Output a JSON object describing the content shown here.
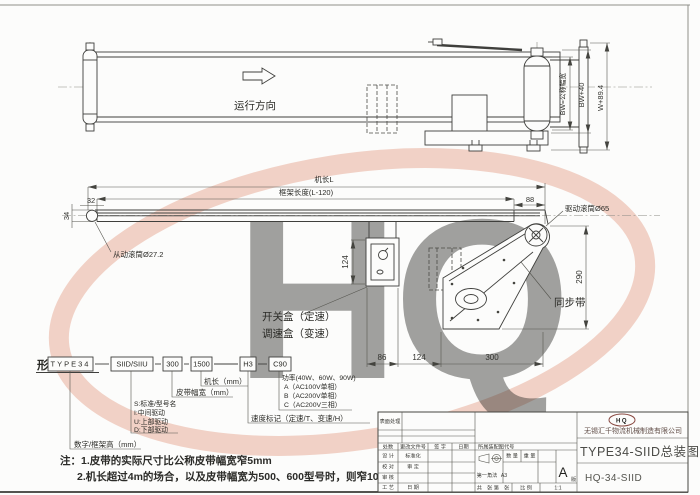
{
  "watermark": {
    "letters": "HQ",
    "color": "#e2957b"
  },
  "top_view": {
    "direction_label": "运行方向",
    "dim_bw": "BW=公称幅宽",
    "dim_bw40": "BW+40",
    "dim_w894": "W+89.4"
  },
  "side_view": {
    "dim_machine_length": "机长L",
    "dim_frame_length": "框架长度(L-120)",
    "dim_32": "32",
    "dim_34": "34",
    "dim_88": "88",
    "dim_290": "290",
    "dim_124_box": "124",
    "label_tail_roller": "从动滚筒Ø27.2",
    "label_drive_roller": "驱动滚筒Ø65",
    "label_sync_belt": "同步带",
    "label_switch_box": "开关盒（定速）",
    "label_speed_box": "调速盒（变速）",
    "dim_86": "86",
    "dim_124": "124",
    "dim_300": "300"
  },
  "designation": {
    "heading": "形式表示",
    "boxes": [
      "TYPE34",
      "SIID/SIIU",
      "300",
      "1500",
      "H3",
      "C90"
    ],
    "label_length": "机长（mm）",
    "label_belt_width": "皮带幅宽（mm）",
    "label_s": "S:标准/型号名",
    "label_i": "I:中间驱动",
    "label_u": "U:上部驱动",
    "label_d": "D:下部驱动",
    "label_frame_height": "数字/框架高（mm）",
    "label_power": "功率(40W、60W、90W)",
    "label_power_a": "A（AC100V单相）",
    "label_power_b": "B（AC200V单相）",
    "label_power_c": "C（AC200V三相）",
    "label_speed": "速度标记（定速/T、变速/H）"
  },
  "notes": {
    "line1": "注：1.皮带的实际尺寸比公称皮带幅宽窄5mm",
    "line2": "2.机长超过4m的场合，以及皮带幅宽为500、600型号时，则窄10mm"
  },
  "title_block": {
    "surface": "表面处理",
    "rev_count": "处数",
    "rev_doc": "更改文件号",
    "rev_sign": "签 字",
    "rev_date": "日期",
    "belongs": "所属装配图代号",
    "design": "设 计",
    "check": "校 对",
    "audit": "审 核",
    "process": "工 艺",
    "standard": "标准化",
    "approve": "审 定",
    "date": "日 期",
    "projection": "第一角法",
    "sheet_size": "A3",
    "qty": "数 量",
    "weight": "重 量",
    "rev": "A",
    "rev_suffix": "版",
    "sheets": "共　张  第　张",
    "scale_label": "比 例",
    "scale_value": "1:1",
    "logo": "HQ",
    "company": "无锡汇千物流机械制造有限公司",
    "title": "TYPE34-SIID总装图",
    "drawing_no": "HQ-34-SIID"
  }
}
